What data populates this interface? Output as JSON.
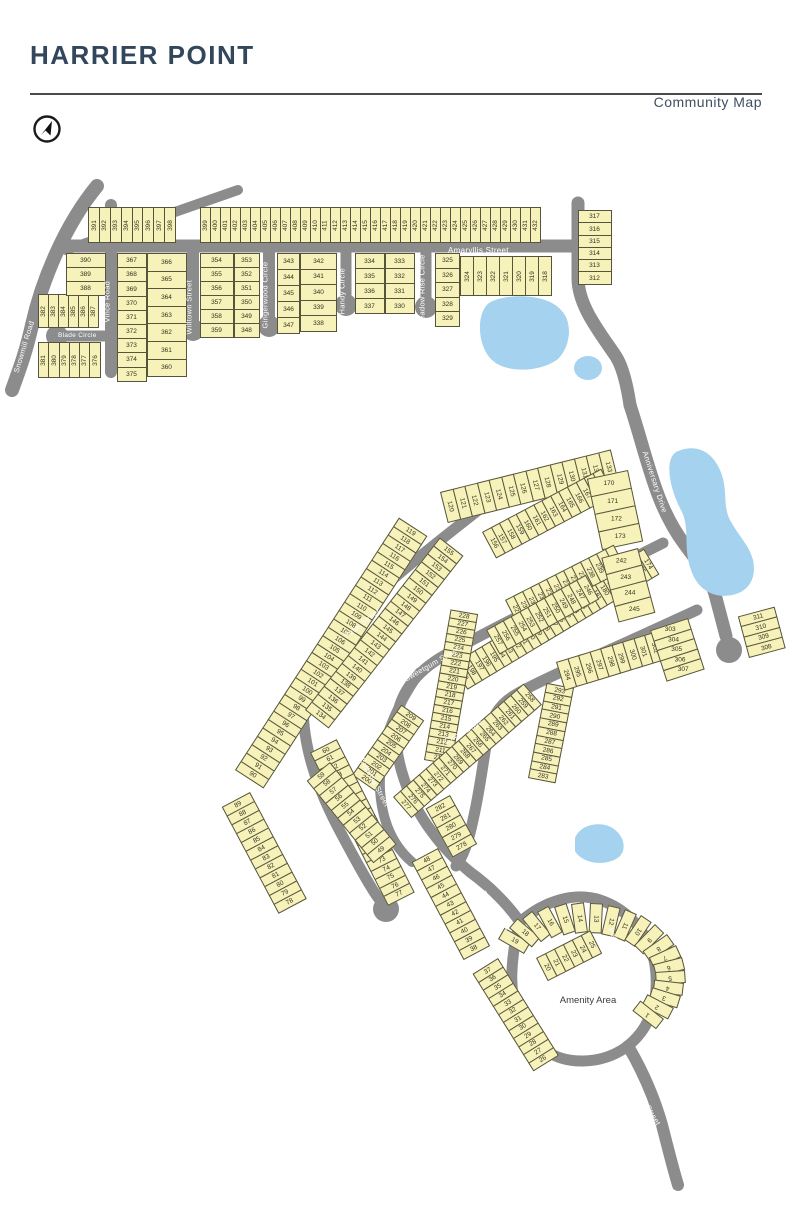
{
  "header": {
    "title": "HARRIER POINT",
    "subtitle": "Community Map"
  },
  "map": {
    "amenity_label": "Amenity Area",
    "colors": {
      "lot": "#f7f1ba",
      "outline": "#55543c",
      "road": "#8c8c8c",
      "water": "#a5d2ee",
      "title": "#32465c"
    },
    "streets": [
      {
        "id": "snowmill",
        "name": "Snowmill Road",
        "x": 16,
        "y": 368,
        "rot": -73
      },
      {
        "id": "blade",
        "name": "Blade Circle",
        "x": 58,
        "y": 332,
        "rot": 0,
        "size": 6.5
      },
      {
        "id": "vince",
        "name": "Vince Road",
        "x": 107,
        "y": 318,
        "rot": -90
      },
      {
        "id": "willtown",
        "name": "Willtown Street",
        "x": 189,
        "y": 330,
        "rot": -90
      },
      {
        "id": "gingerwood",
        "name": "Gingerwood Circle",
        "x": 265,
        "y": 324,
        "rot": -90
      },
      {
        "id": "handy",
        "name": "Handy Circle",
        "x": 342,
        "y": 310,
        "rot": -90
      },
      {
        "id": "meadowrise",
        "name": "Meadow Rise Circle",
        "x": 422,
        "y": 322,
        "rot": -90
      },
      {
        "id": "amaryllis",
        "name": "Amaryllis Street",
        "x": 448,
        "y": 246,
        "rot": 0,
        "size": 8
      },
      {
        "id": "anniversary",
        "name": "Anniversary Drive",
        "x": 645,
        "y": 447,
        "rot": 72
      },
      {
        "id": "petal-upper",
        "name": "Petal Street",
        "x": 345,
        "y": 632,
        "rot": -38
      },
      {
        "id": "petal-lower",
        "name": "Petal Street",
        "x": 312,
        "y": 830,
        "rot": 55
      },
      {
        "id": "sweetgum",
        "name": "Sweetgum Street",
        "x": 405,
        "y": 675,
        "rot": -30
      },
      {
        "id": "eugenia",
        "name": "Eugenia Street",
        "x": 362,
        "y": 754,
        "rot": 62
      },
      {
        "id": "circle-dr",
        "name": "Circle Drive",
        "x": 445,
        "y": 737,
        "rot": -28
      },
      {
        "id": "pecan-w",
        "name": "Pecan Circle",
        "x": 483,
        "y": 887,
        "rot": 56
      },
      {
        "id": "pecan-e",
        "name": "Pecan Circle",
        "x": 610,
        "y": 924,
        "rot": 62
      },
      {
        "id": "hawks-rest",
        "name": "Hawks Rest Street",
        "x": 625,
        "y": 1062,
        "rot": 60
      }
    ],
    "lot_blocks": [
      {
        "x": 88,
        "y": 207,
        "angle": 0,
        "cw": 11.9,
        "ch": 36,
        "tr": -90,
        "from": 391,
        "to": 398
      },
      {
        "x": 200,
        "y": 207,
        "angle": 0,
        "cw": 11,
        "ch": 36,
        "tr": -90,
        "from": 399,
        "to": 432
      },
      {
        "x": 38,
        "y": 294,
        "angle": 0,
        "cw": 11,
        "ch": 34,
        "tr": -90,
        "from": 382,
        "to": 387
      },
      {
        "x": 38,
        "y": 342,
        "angle": 0,
        "cw": 11.3,
        "ch": 36,
        "tr": -90,
        "from": 381,
        "to": 376
      },
      {
        "x": 460,
        "y": 256,
        "angle": 0,
        "cw": 14,
        "ch": 40,
        "tr": -90,
        "from": 324,
        "to": 318
      },
      {
        "x": 106,
        "y": 253,
        "angle": 90,
        "cw": 15,
        "ch": 40,
        "tr": -90,
        "from": 390,
        "to": 388
      },
      {
        "x": 147,
        "y": 253,
        "angle": 90,
        "cw": 15.2,
        "ch": 30,
        "tr": -90,
        "from": 367,
        "to": 375
      },
      {
        "x": 187,
        "y": 253,
        "angle": 90,
        "cw": 18.6,
        "ch": 40,
        "tr": -90,
        "from": 366,
        "to": 360
      },
      {
        "x": 234,
        "y": 253,
        "angle": 90,
        "cw": 15,
        "ch": 34,
        "tr": -90,
        "from": 354,
        "to": 359
      },
      {
        "x": 260,
        "y": 253,
        "angle": 90,
        "cw": 15,
        "ch": 26,
        "tr": -90,
        "from": 353,
        "to": 348
      },
      {
        "x": 300,
        "y": 253,
        "angle": 90,
        "cw": 17,
        "ch": 23,
        "tr": -90,
        "from": 343,
        "to": 347
      },
      {
        "x": 337,
        "y": 253,
        "angle": 90,
        "cw": 16.5,
        "ch": 37,
        "tr": -90,
        "from": 342,
        "to": 338
      },
      {
        "x": 385,
        "y": 253,
        "angle": 90,
        "cw": 16,
        "ch": 30,
        "tr": -90,
        "from": 334,
        "to": 337
      },
      {
        "x": 415,
        "y": 253,
        "angle": 90,
        "cw": 16,
        "ch": 30,
        "tr": -90,
        "from": 333,
        "to": 330
      },
      {
        "x": 460,
        "y": 253,
        "angle": 90,
        "cw": 15.5,
        "ch": 25,
        "tr": -90,
        "from": 325,
        "to": 329
      },
      {
        "x": 612,
        "y": 210,
        "angle": 90,
        "cw": 13.3,
        "ch": 34,
        "tr": -90,
        "from": 317,
        "to": 312
      },
      {
        "x": 235,
        "y": 770,
        "angle": -57,
        "cw": 11,
        "ch": 34,
        "tr": 90,
        "from": 90,
        "to": 119
      },
      {
        "x": 440,
        "y": 492,
        "angle": -14,
        "cw": 13.5,
        "ch": 32,
        "tr": 90,
        "from": 120,
        "to": 133
      },
      {
        "x": 305,
        "y": 710,
        "angle": -52,
        "cw": 10.9,
        "ch": 30,
        "tr": 90,
        "from": 134,
        "to": 155
      },
      {
        "x": 482,
        "y": 532,
        "angle": -28,
        "cw": 10.6,
        "ch": 30,
        "tr": 90,
        "from": 156,
        "to": 169
      },
      {
        "x": 628,
        "y": 470,
        "angle": 78,
        "cw": 19,
        "ch": 42,
        "tr": -78,
        "from": 170,
        "to": 173
      },
      {
        "x": 452,
        "y": 664,
        "angle": -31,
        "cw": 9.6,
        "ch": 30,
        "tr": 90,
        "from": 199,
        "to": 174
      },
      {
        "x": 352,
        "y": 775,
        "angle": -55,
        "cw": 9.5,
        "ch": 28,
        "tr": 90,
        "from": 200,
        "to": 209
      },
      {
        "x": 424,
        "y": 760,
        "angle": -80,
        "cw": 9,
        "ch": 28,
        "tr": 90,
        "from": 210,
        "to": 228
      },
      {
        "x": 505,
        "y": 600,
        "angle": -27,
        "cw": 10.3,
        "ch": 28,
        "tr": 90,
        "from": 229,
        "to": 241
      },
      {
        "x": 638,
        "y": 548,
        "angle": 75,
        "cw": 17.5,
        "ch": 38,
        "tr": -75,
        "from": 242,
        "to": 245
      },
      {
        "x": 486,
        "y": 630,
        "angle": -29,
        "cw": 10.4,
        "ch": 28,
        "tr": 90,
        "from": 257,
        "to": 246
      },
      {
        "x": 393,
        "y": 797,
        "angle": -41,
        "cw": 9.6,
        "ch": 28,
        "tr": 90,
        "from": 277,
        "to": 258
      },
      {
        "x": 450,
        "y": 795,
        "angle": 61,
        "cw": 12,
        "ch": 28,
        "tr": -90,
        "from": 282,
        "to": 278
      },
      {
        "x": 528,
        "y": 778,
        "angle": -79,
        "cw": 9.7,
        "ch": 28,
        "tr": 90,
        "from": 283,
        "to": 293
      },
      {
        "x": 556,
        "y": 662,
        "angle": -17,
        "cw": 12.5,
        "ch": 30,
        "tr": 90,
        "from": 294,
        "to": 302
      },
      {
        "x": 688,
        "y": 618,
        "angle": 72,
        "cw": 11.5,
        "ch": 40,
        "tr": -72,
        "from": 303,
        "to": 307
      },
      {
        "x": 749,
        "y": 658,
        "angle": -105,
        "cw": 11.5,
        "ch": 38,
        "tr": 90,
        "from": 308,
        "to": 311
      },
      {
        "x": 250,
        "y": 792,
        "angle": 62,
        "cw": 11,
        "ch": 32,
        "tr": -90,
        "from": 89,
        "to": 78
      },
      {
        "x": 388,
        "y": 906,
        "angle": -117,
        "cw": 10.5,
        "ch": 30,
        "tr": 90,
        "from": 77,
        "to": 60
      },
      {
        "x": 330,
        "y": 762,
        "angle": 51,
        "cw": 10.5,
        "ch": 30,
        "tr": -90,
        "from": 59,
        "to": 49
      },
      {
        "x": 438,
        "y": 848,
        "angle": 62,
        "cw": 11,
        "ch": 30,
        "tr": -90,
        "from": 48,
        "to": 38
      },
      {
        "x": 498,
        "y": 958,
        "angle": 58,
        "cw": 10.5,
        "ch": 30,
        "tr": -90,
        "from": 37,
        "to": 26
      },
      {
        "x": 536,
        "y": 958,
        "angle": -27,
        "cw": 11,
        "ch": 26,
        "tr": 90,
        "from": 20,
        "to": 25
      },
      {
        "type": "arc",
        "cx": 585,
        "cy": 975,
        "rx": 100,
        "ry": 72,
        "a0": 150,
        "a1": -38,
        "from": 19,
        "to": 1,
        "cw": 13,
        "ch": 30,
        "tr": 90
      }
    ]
  }
}
